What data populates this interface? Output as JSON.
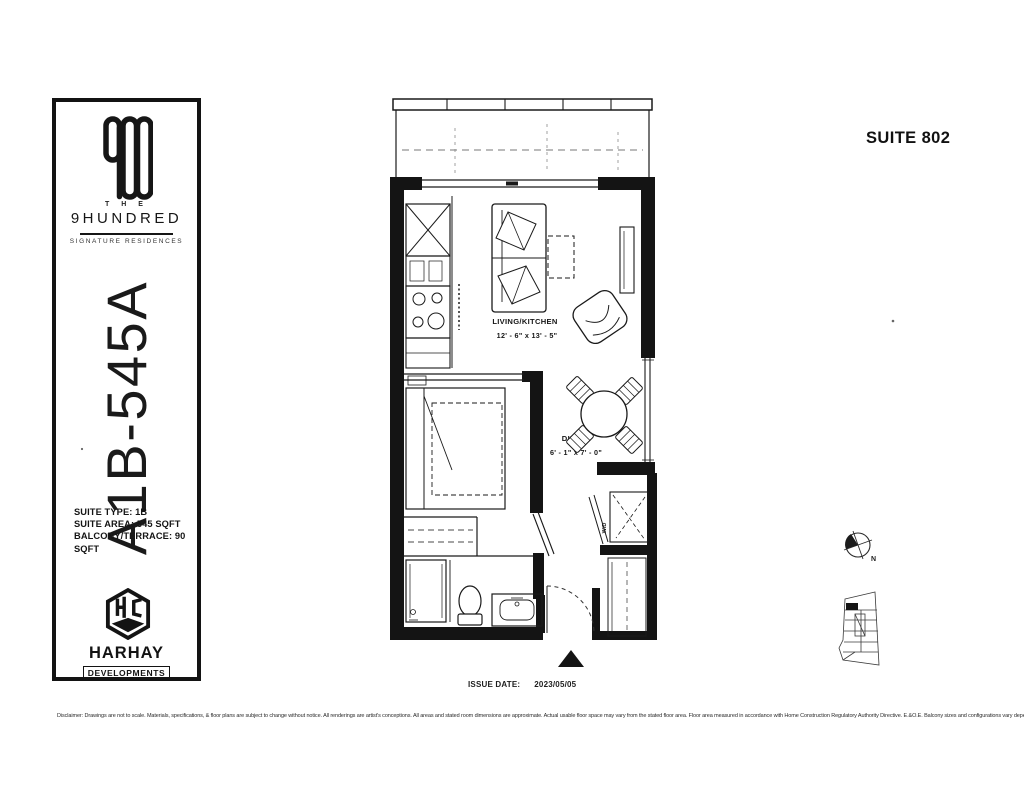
{
  "header": {
    "suite_label": "SUITE 802"
  },
  "sidebar": {
    "brand_logo_icon": "900-monogram",
    "brand_the": "T H E",
    "brand_name": "9HUNDRED",
    "brand_tagline": "SIGNATURE RESIDENCES",
    "unit_code": "A1B-545A",
    "suite_type": "SUITE TYPE: 1B",
    "suite_area": "SUITE AREA: 545 SQFT",
    "balcony_area": "BALCONY/TERRACE: 90 SQFT",
    "developer_logo_icon": "hexagon-hc-monogram",
    "developer_name": "HARHAY",
    "developer_sub": "DEVELOPMENTS"
  },
  "plan": {
    "living_name": "LIVING/KITCHEN",
    "living_dims": "12' - 6\" x 13' - 5\"",
    "bedroom_name": "BEDROOM",
    "bedroom_dims": "8' - 10\" x 9' - 9\"",
    "dining_name": "DINING",
    "dining_dims": "6' - 1\" x 7' - 0\"",
    "wd_label": "W/D",
    "north_label": "N",
    "north_arrow_icon": "north-compass",
    "entry_arrow_icon": "entry-triangle",
    "keyplan_icon": "building-keyplan"
  },
  "footer": {
    "issue_date_label": "ISSUE DATE:",
    "issue_date_value": "2023/05/05",
    "disclaimer": "Disclaimer: Drawings are not to scale. Materials, specifications, & floor plans are subject to change without notice. All renderings are artist's conceptions. All areas and stated room dimensions are approximate. Actual usable floor space may vary from the stated floor area. Floor area measured in accordance with Home Construction Regulatory Authority Directive. E.&O.E. Balcony sizes and configurations vary depending on floor level locations."
  }
}
